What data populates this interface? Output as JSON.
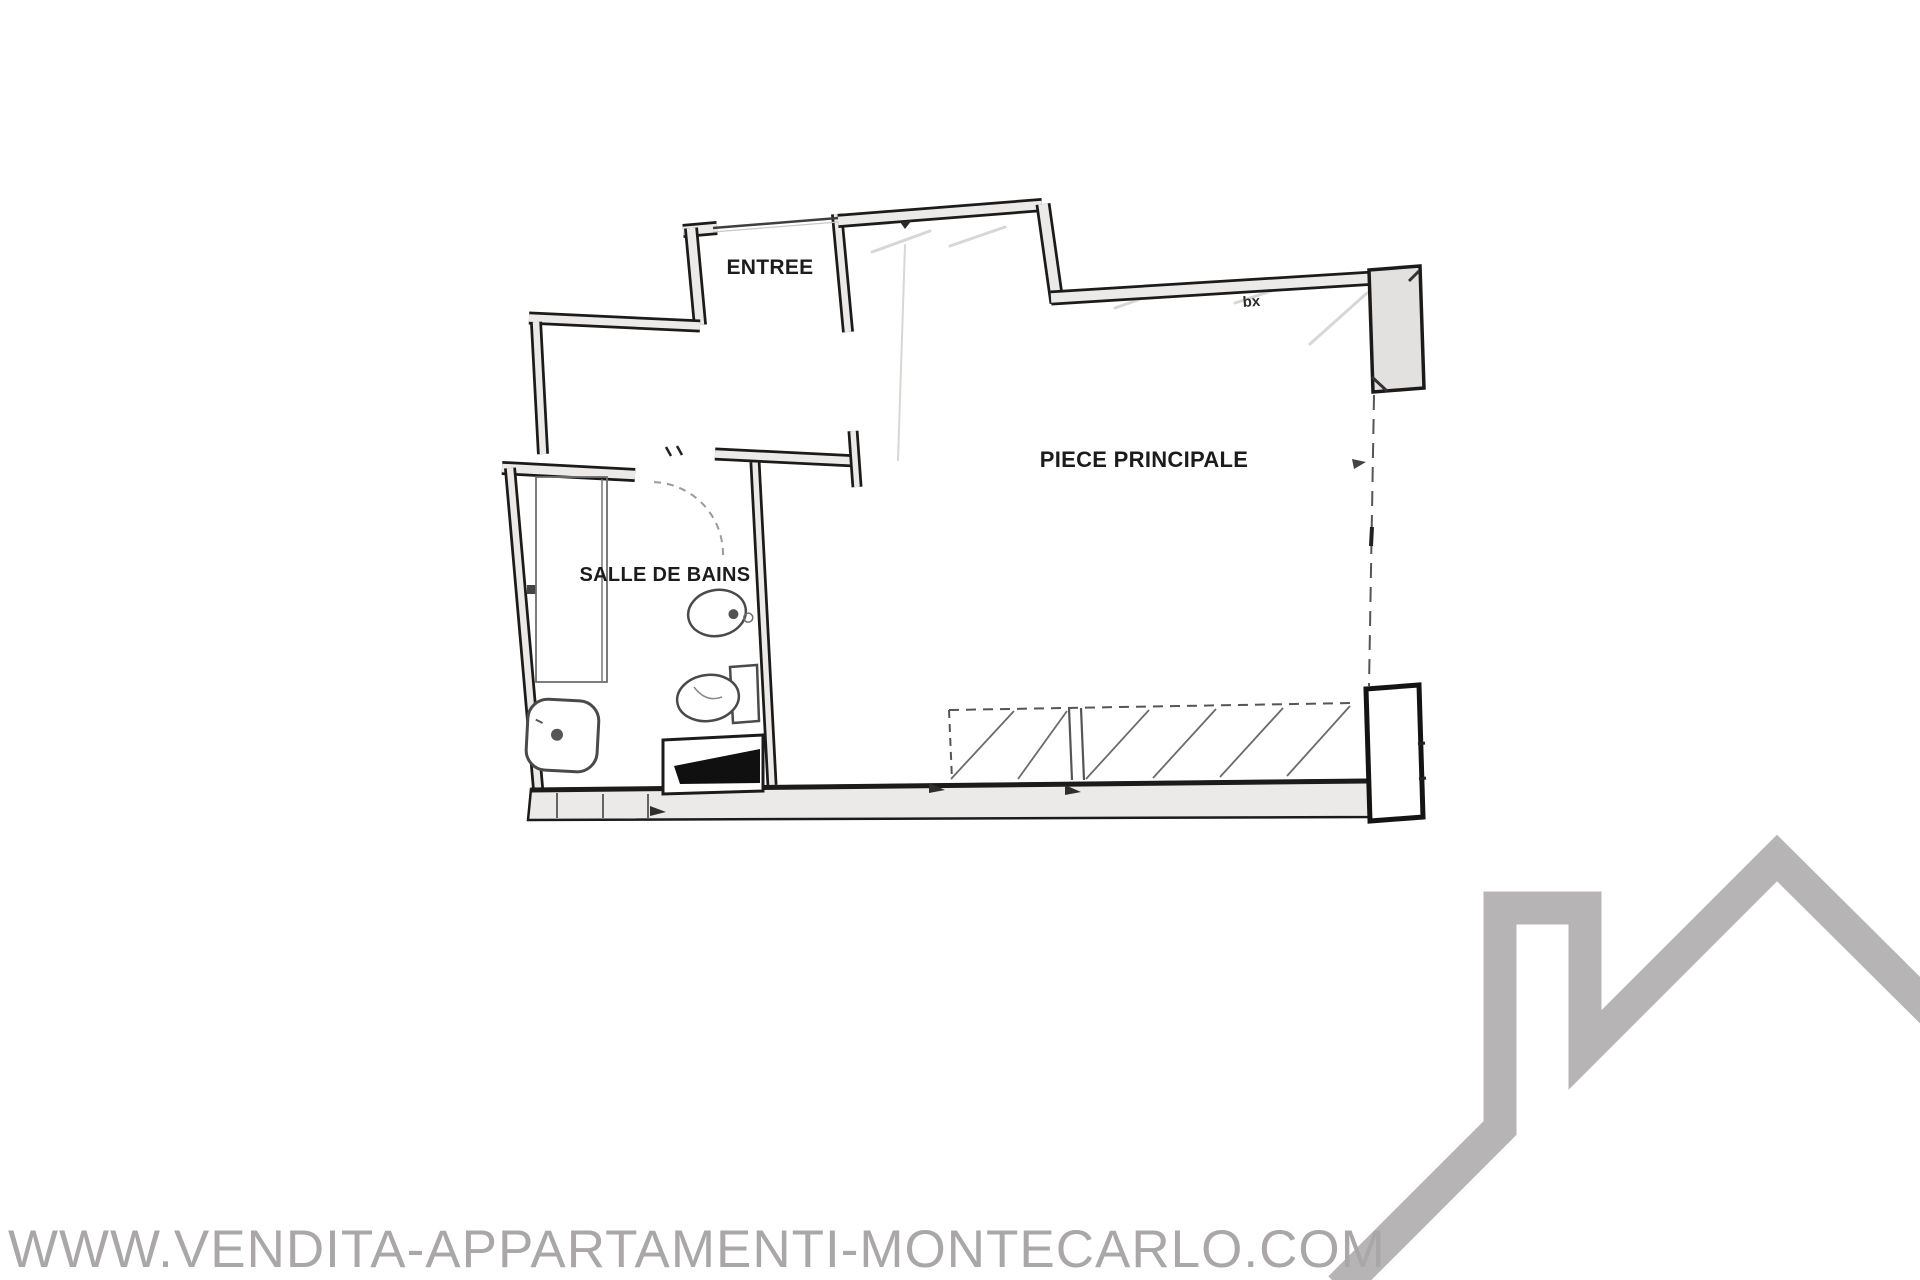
{
  "floor_plan": {
    "rooms": [
      {
        "id": "entree",
        "label": "ENTREE"
      },
      {
        "id": "piece_principale",
        "label": "PIECE PRINCIPALE"
      },
      {
        "id": "salle_de_bains",
        "label": "SALLE DE BAINS"
      }
    ],
    "annotations": [
      {
        "id": "wall_note",
        "label": "bx"
      }
    ]
  },
  "watermark": {
    "text": "WWW.VENDITA-APPARTAMENTI-MONTECARLO.COM"
  },
  "logo": {
    "name": "house-roofline-logo"
  },
  "theme": {
    "wall_line": "#1b1b1b",
    "wall_fill": "#eceae8",
    "pillar_fill": "#e3e1df",
    "fixture_line": "#4a4a4a",
    "pencil_shading": "#d9d7d5",
    "label_color": "#1c1c1c",
    "watermark_color": "#a9a7a7",
    "logo_color": "#b6b4b4",
    "background": "#ffffff"
  }
}
